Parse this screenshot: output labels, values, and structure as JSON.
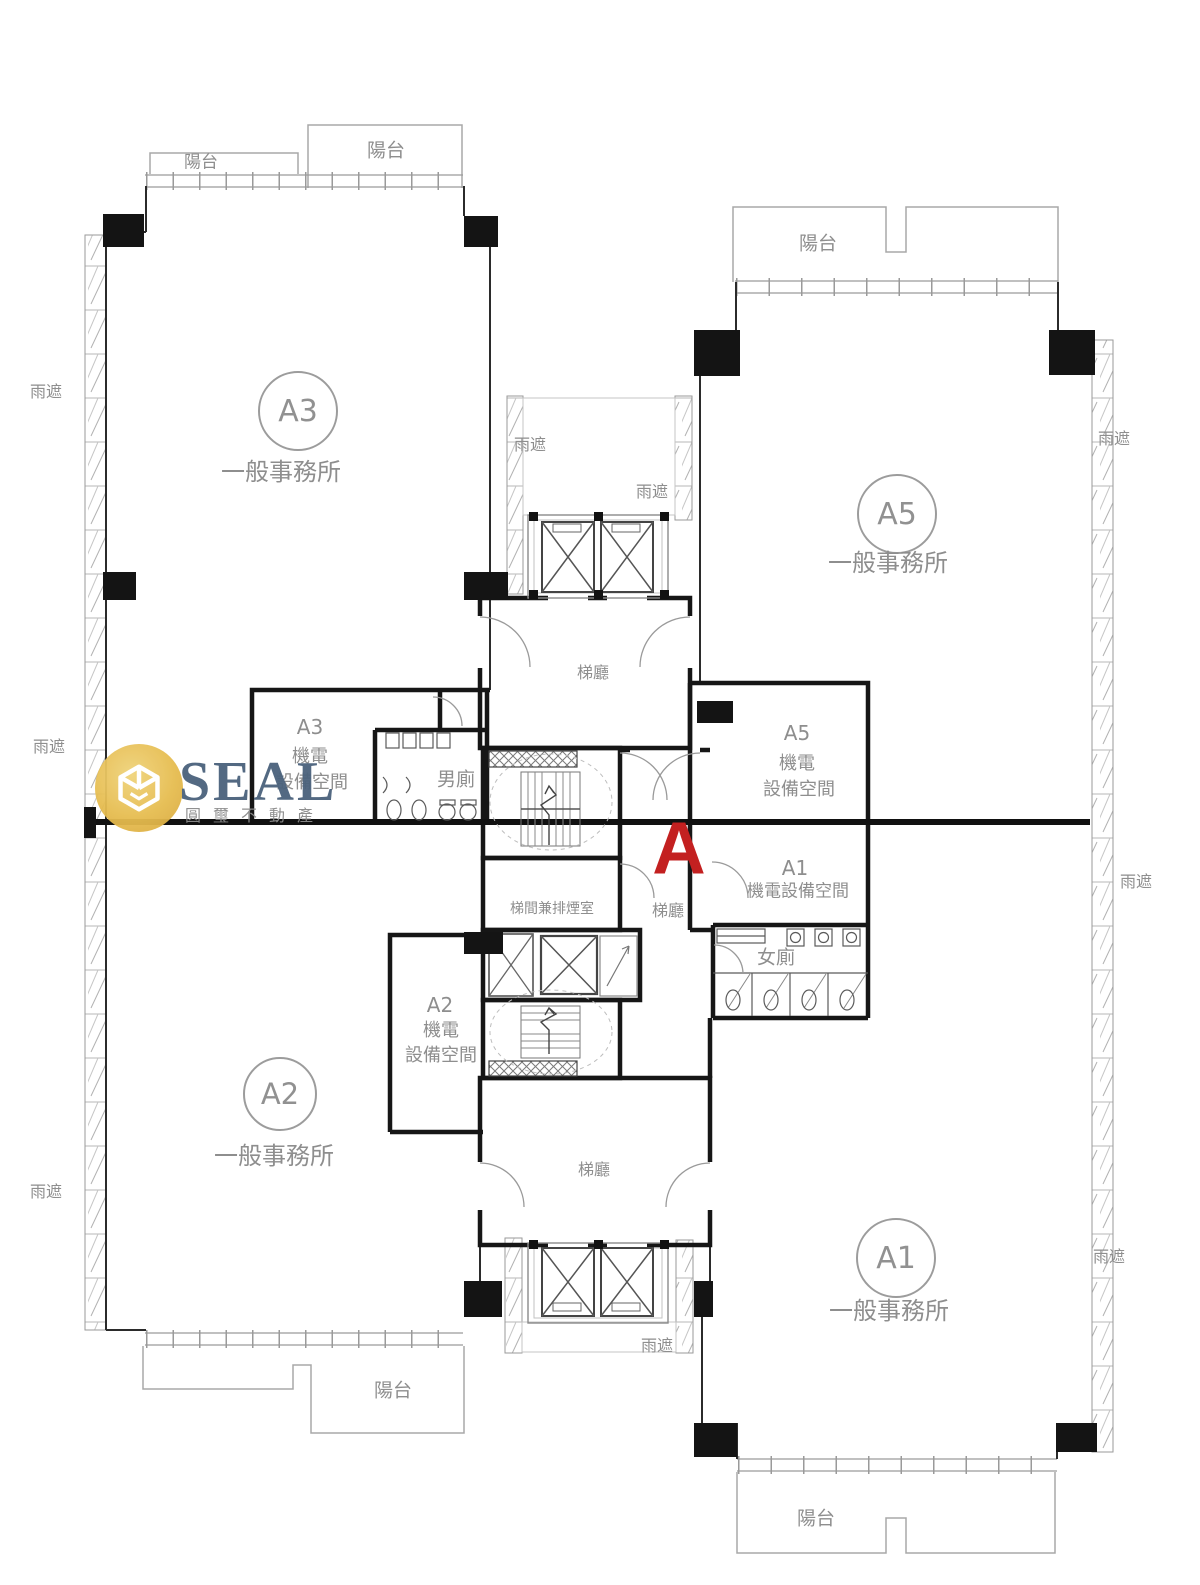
{
  "watermark": {
    "brand": "SEAL",
    "company": "圓璽不動產",
    "logo_color": "#E3BC4F",
    "brand_color": "#4A627C"
  },
  "zone_label": {
    "text": "A",
    "color": "#C32020"
  },
  "units": {
    "a3": {
      "id": "A3",
      "type": "一般事務所"
    },
    "a5": {
      "id": "A5",
      "type": "一般事務所"
    },
    "a2": {
      "id": "A2",
      "type": "一般事務所"
    },
    "a1": {
      "id": "A1",
      "type": "一般事務所"
    }
  },
  "mech_rooms": {
    "a3": {
      "id": "A3",
      "line1": "機電",
      "line2": "設備空間"
    },
    "a5": {
      "id": "A5",
      "line1": "機電",
      "line2": "設備空間"
    },
    "a2": {
      "id": "A2",
      "line1": "機電",
      "line2": "設備空間"
    },
    "a1": {
      "id": "A1",
      "line1": "機電設備空間"
    }
  },
  "rooms": {
    "mens_toilet": "男廁",
    "womens_toilet": "女廁",
    "elevator_hall": "梯廳",
    "stair_smoke_room": "梯間兼排煙室"
  },
  "annotations": {
    "balcony": "陽台",
    "rain_shield": "雨遮"
  }
}
